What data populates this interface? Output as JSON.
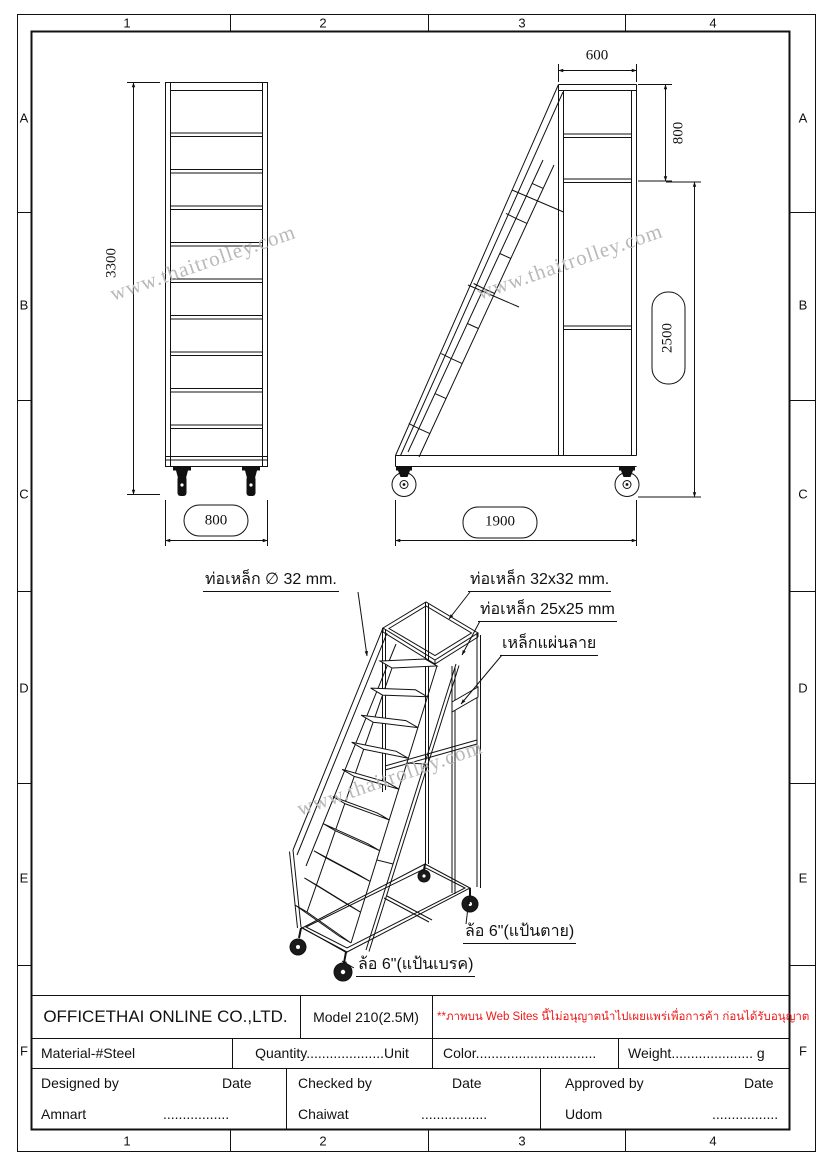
{
  "sheet": {
    "grid": {
      "columns": [
        "1",
        "2",
        "3",
        "4"
      ],
      "rows": [
        "A",
        "B",
        "C",
        "D",
        "E",
        "F"
      ]
    },
    "watermark": {
      "text": "www.thaitrolley.com",
      "color": "#b9b9b9"
    }
  },
  "views": {
    "front": {
      "height_dim": "3300",
      "width_dim": "800"
    },
    "side": {
      "top_width_dim": "600",
      "upper_height_dim": "800",
      "lower_height_dim": "2500",
      "base_length_dim": "1900"
    }
  },
  "callouts": {
    "tube_round": "ท่อเหล็ก ∅ 32 mm.",
    "tube_square_32": "ท่อเหล็ก 32x32 mm.",
    "tube_square_25": "ท่อเหล็ก 25x25 mm",
    "checker_plate": "เหล็กแผ่นลาย",
    "caster_fixed": "ล้อ 6\"(แป้นตาย)",
    "caster_brake": "ล้อ 6\"(แป้นเบรค)"
  },
  "title_block": {
    "company": "OFFICETHAI ONLINE CO.,LTD.",
    "model": "Model 210(2.5M)",
    "notice": "**ภาพบน Web Sites นี้ไม่อนุญาตนำไปเผยแพร่เพื่อการค้า ก่อนได้รับอนุญาต",
    "notice_color": "#f01818",
    "material": "Material-#Steel",
    "quantity": "Quantity....................Unit",
    "color": "Color...............................",
    "weight": "Weight..................... g",
    "designed_by_label": "Designed by",
    "checked_by_label": "Checked by",
    "approved_by_label": "Approved by",
    "date_label": "Date",
    "designer": "Amnart",
    "checker": "Chaiwat",
    "approver": "Udom",
    "dots": "................."
  }
}
